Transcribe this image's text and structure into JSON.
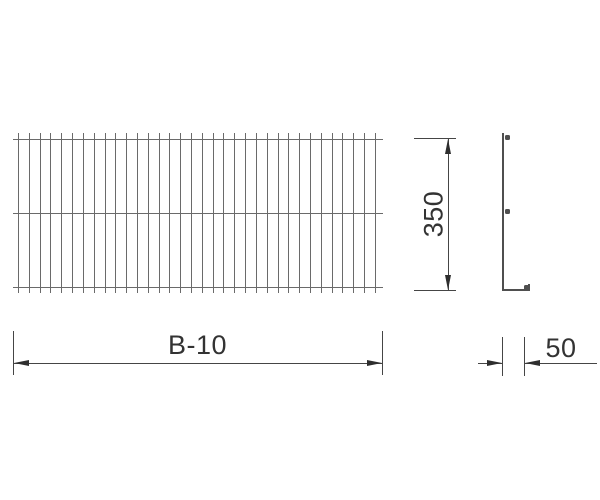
{
  "drawing": {
    "type": "technical-drawing",
    "views": {
      "front_view": {
        "description": "wire mesh panel front elevation",
        "vertical_wire_count": 34,
        "horizontal_wire_count": 3
      },
      "side_view": {
        "description": "L-shaped wire profile with three wire cross-section dots"
      }
    },
    "dimensions": {
      "width": {
        "label": "B-10"
      },
      "height": {
        "label": "350"
      },
      "foot": {
        "label": "50"
      }
    },
    "colors": {
      "bg": "#ffffff",
      "wire": "#6a6a6a",
      "profile": "#4f4f4f",
      "dim": "#454545",
      "arrow": "#2e2e2e",
      "text": "#333333"
    }
  }
}
